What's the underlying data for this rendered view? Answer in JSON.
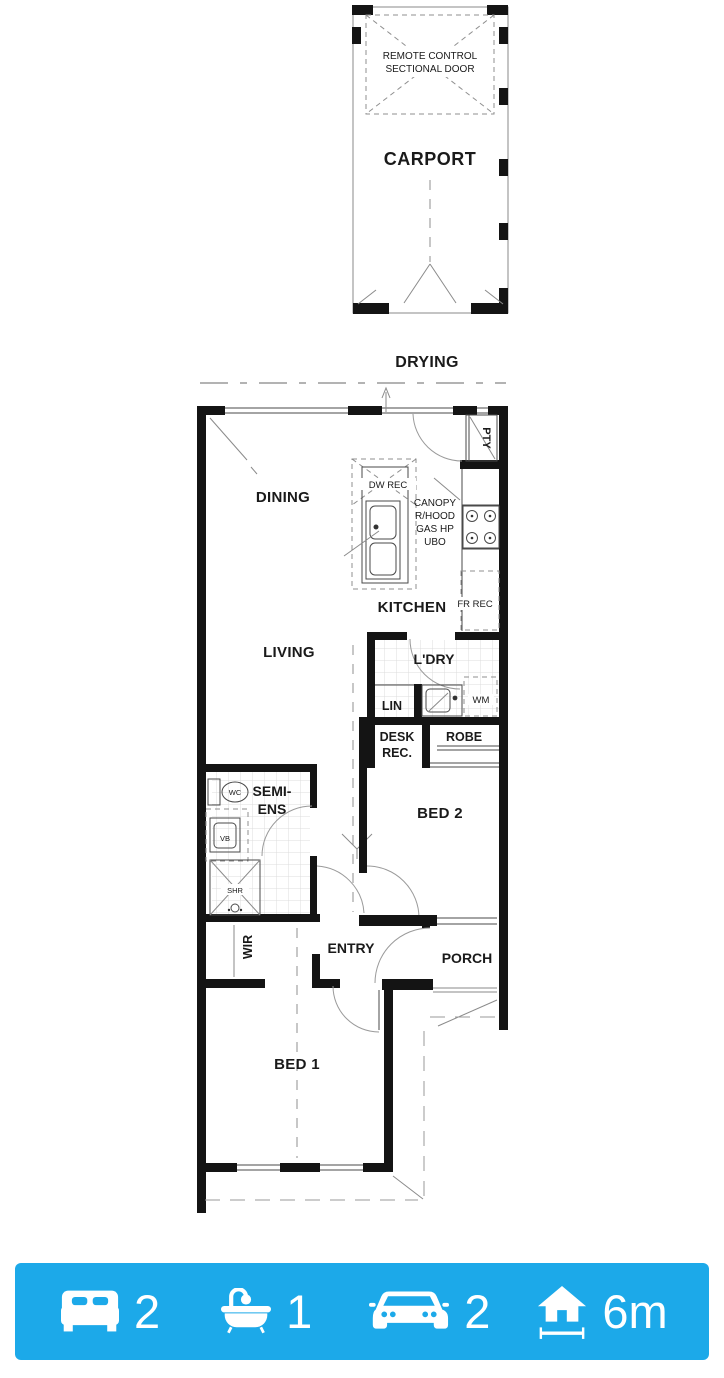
{
  "meta": {
    "accent_blue": "#1CA9E9",
    "wall_color": "#141414"
  },
  "carport": {
    "name": "CARPORT",
    "door_lines": [
      "REMOTE CONTROL",
      "SECTIONAL DOOR"
    ]
  },
  "plan": {
    "drying": "DRYING",
    "pty": "PTY",
    "dw_rec": "DW REC",
    "canopy_lines": [
      "CANOPY",
      "R/HOOD",
      "GAS HP",
      "UBO"
    ],
    "kitchen": "KITCHEN",
    "fr_rec": "FR REC",
    "dining": "DINING",
    "living": "LIVING",
    "ldry": "L'DRY",
    "lin": "LIN",
    "wm": "WM",
    "desk_rec_lines": [
      "DESK",
      "REC."
    ],
    "robe": "ROBE",
    "bed2": "BED 2",
    "semi_ens_lines": [
      "SEMI-",
      "ENS"
    ],
    "wc": "WC",
    "vb": "VB",
    "shr": "SHR",
    "wir": "WIR",
    "entry": "ENTRY",
    "porch": "PORCH",
    "bed1": "BED 1"
  },
  "summary_bar": {
    "background": "#1CA9E9",
    "items": [
      {
        "icon": "bed-icon",
        "value": "2"
      },
      {
        "icon": "bath-icon",
        "value": "1"
      },
      {
        "icon": "car-icon",
        "value": "2"
      },
      {
        "icon": "house-width-icon",
        "value": "6m"
      }
    ]
  }
}
